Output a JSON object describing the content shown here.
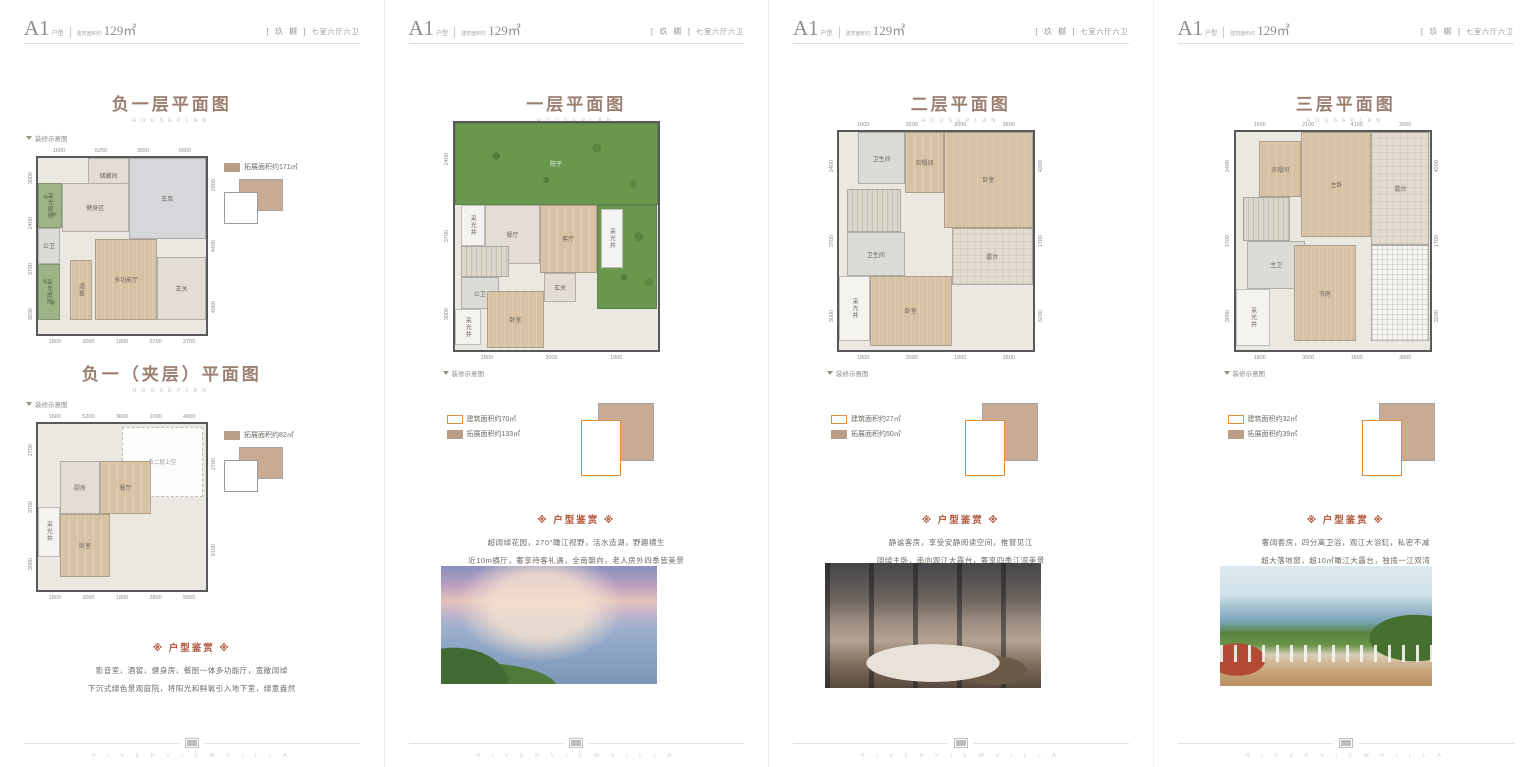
{
  "page": {
    "footer_en": "R I V E R V I E W   V I L L A"
  },
  "labels": {
    "houseplan": "HOUSEPLAN",
    "decor_note": "装修示意图",
    "appreciation_title": "※ 户型鉴赏 ※"
  },
  "header": {
    "type": "A1",
    "type_suffix": "户型",
    "area_prefix": "建筑面积约",
    "area": "129㎡",
    "brand_bracketed": "[ 玖 樾 ]",
    "rooms": "七室六厅六卫"
  },
  "colors": {
    "title_brown": "#9c8172",
    "accent_red": "#b0563b",
    "expand_tan": "#bb9e86",
    "build_orange": "#df8f3e",
    "garden_green": "#68984e"
  },
  "panels": [
    {
      "plans": [
        {
          "title": "负一层平面图",
          "legend": [
            {
              "swatch": "expand",
              "text": "拓展面积约171㎡"
            }
          ],
          "dims": {
            "top": [
              "1600",
              "5200",
              "3550",
              "5650"
            ],
            "bottom": [
              "1800",
              "3000",
              "1800",
              "6700",
              "2700"
            ],
            "left": [
              "3000",
              "2400",
              "3700",
              "3030"
            ],
            "right": [
              "2900",
              "4490",
              "4060"
            ]
          },
          "rooms": [
            {
              "label": "储藏间",
              "cls": "tile",
              "x": 30,
              "y": 0,
              "w": 24,
              "h": 20
            },
            {
              "label": "车库",
              "cls": "garage",
              "x": 54,
              "y": 0,
              "w": 46,
              "h": 46
            },
            {
              "label": "健身区",
              "cls": "tile",
              "x": 14,
              "y": 14,
              "w": 40,
              "h": 28
            },
            {
              "label": "采光庭院",
              "cls": "court",
              "x": 0,
              "y": 14,
              "w": 14,
              "h": 26,
              "v": true
            },
            {
              "label": "公卫",
              "cls": "bath",
              "x": 0,
              "y": 40,
              "w": 13,
              "h": 20
            },
            {
              "label": "采光庭院",
              "cls": "court",
              "x": 0,
              "y": 60,
              "w": 13,
              "h": 32,
              "v": true
            },
            {
              "label": "酒窖",
              "cls": "wood",
              "x": 19,
              "y": 58,
              "w": 13,
              "h": 34,
              "v": true
            },
            {
              "label": "多功能厅",
              "cls": "wood",
              "x": 34,
              "y": 46,
              "w": 37,
              "h": 46
            },
            {
              "label": "玄关",
              "cls": "tile",
              "x": 71,
              "y": 56,
              "w": 29,
              "h": 36
            }
          ]
        },
        {
          "title": "负一（夹层）平面图",
          "legend": [
            {
              "swatch": "expand",
              "text": "拓展面积约82㎡"
            }
          ],
          "dims": {
            "top": [
              "1600",
              "5200",
              "3600",
              "1000",
              "4600"
            ],
            "bottom": [
              "1800",
              "3000",
              "1800",
              "3800",
              "5600"
            ],
            "left": [
              "2700",
              "3700",
              "3000"
            ],
            "right": [
              "2700",
              "9100"
            ]
          },
          "rooms": [
            {
              "label": "负二层上空",
              "cls": "void",
              "x": 50,
              "y": 2,
              "w": 48,
              "h": 42
            },
            {
              "label": "厨房",
              "cls": "tile",
              "x": 13,
              "y": 22,
              "w": 24,
              "h": 32
            },
            {
              "label": "餐厅",
              "cls": "wood",
              "x": 37,
              "y": 22,
              "w": 30,
              "h": 32
            },
            {
              "label": "采光井",
              "cls": "light",
              "x": 0,
              "y": 50,
              "w": 13,
              "h": 30,
              "v": true
            },
            {
              "label": "卧室",
              "cls": "wood",
              "x": 13,
              "y": 54,
              "w": 30,
              "h": 38
            }
          ]
        }
      ],
      "appreciation": [
        "影音室、酒窖、健身房、餐厨一体多功能厅，宽敞阔绰",
        "下沉式绿色景观庭院，将阳光和鲜氧引入地下室，绿意盎然"
      ]
    },
    {
      "plans": [
        {
          "title": "一层平面图",
          "legend": [
            {
              "swatch": "build",
              "text": "建筑面积约70㎡"
            },
            {
              "swatch": "expand",
              "text": "拓展面积约133㎡"
            }
          ],
          "dims": {
            "top": [],
            "bottom": [
              "1800",
              "3000",
              "1800"
            ],
            "left": [
              "2400",
              "3700",
              "3000"
            ],
            "right": []
          },
          "rooms": [
            {
              "label": "院子",
              "cls": "garden",
              "x": 0,
              "y": 0,
              "w": 100,
              "h": 36
            },
            {
              "label": "",
              "cls": "garden",
              "x": 70,
              "y": 36,
              "w": 30,
              "h": 46
            },
            {
              "label": "采光井",
              "cls": "light",
              "x": 3,
              "y": 36,
              "w": 12,
              "h": 18,
              "v": true
            },
            {
              "label": "餐厅",
              "cls": "tile",
              "x": 15,
              "y": 36,
              "w": 27,
              "h": 26
            },
            {
              "label": "客厅",
              "cls": "wood",
              "x": 42,
              "y": 36,
              "w": 28,
              "h": 30
            },
            {
              "label": "采光井",
              "cls": "light",
              "x": 72,
              "y": 38,
              "w": 11,
              "h": 26,
              "v": true
            },
            {
              "label": "",
              "cls": "stairs",
              "x": 3,
              "y": 54,
              "w": 24,
              "h": 14
            },
            {
              "label": "公卫",
              "cls": "bath",
              "x": 3,
              "y": 68,
              "w": 19,
              "h": 14
            },
            {
              "label": "玄关",
              "cls": "tile",
              "x": 44,
              "y": 66,
              "w": 16,
              "h": 13
            },
            {
              "label": "采光井",
              "cls": "light",
              "x": 0,
              "y": 82,
              "w": 13,
              "h": 16,
              "v": true
            },
            {
              "label": "卧室",
              "cls": "wood",
              "x": 16,
              "y": 74,
              "w": 28,
              "h": 25
            }
          ]
        }
      ],
      "appreciation": [
        "超阔绰花园，270°瞰江视野，活水造湖，野趣横生",
        "近10m横厅，奢享待客礼遇，全南朝向，老人房外四季皆美景"
      ],
      "photo": "river-sunset"
    },
    {
      "plans": [
        {
          "title": "二层平面图",
          "legend": [
            {
              "swatch": "build",
              "text": "建筑面积约27㎡"
            },
            {
              "swatch": "expand",
              "text": "拓展面积约50㎡"
            }
          ],
          "dims": {
            "top": [
              "1600",
              "3200",
              "2000",
              "3600"
            ],
            "bottom": [
              "1800",
              "3000",
              "1800",
              "3800"
            ],
            "left": [
              "2400",
              "3700",
              "3000"
            ],
            "right": [
              "4200",
              "1700",
              "3200"
            ]
          },
          "rooms": [
            {
              "label": "卫生间",
              "cls": "bath",
              "x": 10,
              "y": 0,
              "w": 24,
              "h": 24
            },
            {
              "label": "衣帽间",
              "cls": "wood",
              "x": 34,
              "y": 0,
              "w": 20,
              "h": 28
            },
            {
              "label": "卧室",
              "cls": "wood",
              "x": 54,
              "y": 0,
              "w": 46,
              "h": 44
            },
            {
              "label": "露台",
              "cls": "paver",
              "x": 58,
              "y": 44,
              "w": 42,
              "h": 26
            },
            {
              "label": "",
              "cls": "stairs",
              "x": 4,
              "y": 26,
              "w": 28,
              "h": 20
            },
            {
              "label": "卫生间",
              "cls": "bath",
              "x": 4,
              "y": 46,
              "w": 30,
              "h": 20
            },
            {
              "label": "采光井",
              "cls": "light",
              "x": 0,
              "y": 66,
              "w": 16,
              "h": 30,
              "v": true
            },
            {
              "label": "卧室",
              "cls": "wood",
              "x": 16,
              "y": 66,
              "w": 42,
              "h": 32
            }
          ]
        }
      ],
      "appreciation": [
        "静谧客房，享受安静阅读空间，推窗见江",
        "阔绰主卧，南向观江大露台，奢享四季江湾美景"
      ],
      "photo": "bedroom"
    },
    {
      "plans": [
        {
          "title": "三层平面图",
          "legend": [
            {
              "swatch": "build",
              "text": "建筑面积约32㎡"
            },
            {
              "swatch": "expand",
              "text": "拓展面积约39㎡"
            }
          ],
          "dims": {
            "top": [
              "1600",
              "2100",
              "4100",
              "2600"
            ],
            "bottom": [
              "1800",
              "3000",
              "1800",
              "3800"
            ],
            "left": [
              "2400",
              "3700",
              "3000"
            ],
            "right": [
              "4200",
              "1700",
              "3200"
            ]
          },
          "rooms": [
            {
              "label": "衣帽间",
              "cls": "wood",
              "x": 12,
              "y": 4,
              "w": 22,
              "h": 26
            },
            {
              "label": "主卧",
              "cls": "wood",
              "x": 34,
              "y": 0,
              "w": 36,
              "h": 48
            },
            {
              "label": "露台",
              "cls": "paver",
              "x": 70,
              "y": 0,
              "w": 30,
              "h": 52
            },
            {
              "label": "",
              "cls": "stairs",
              "x": 4,
              "y": 30,
              "w": 24,
              "h": 20
            },
            {
              "label": "主卫",
              "cls": "bath",
              "x": 6,
              "y": 50,
              "w": 30,
              "h": 22
            },
            {
              "label": "采光井",
              "cls": "light",
              "x": 0,
              "y": 72,
              "w": 18,
              "h": 26,
              "v": true
            },
            {
              "label": "书房",
              "cls": "wood",
              "x": 30,
              "y": 52,
              "w": 32,
              "h": 44
            },
            {
              "label": "",
              "cls": "hatch",
              "x": 70,
              "y": 52,
              "w": 30,
              "h": 44
            }
          ]
        }
      ],
      "appreciation": [
        "奢阔套房，四分离卫浴，观江大浴缸，私密不减",
        "超大落地窗，超10㎡瞰江大露台，独揽一江双湾"
      ],
      "photo": "terrace"
    }
  ]
}
